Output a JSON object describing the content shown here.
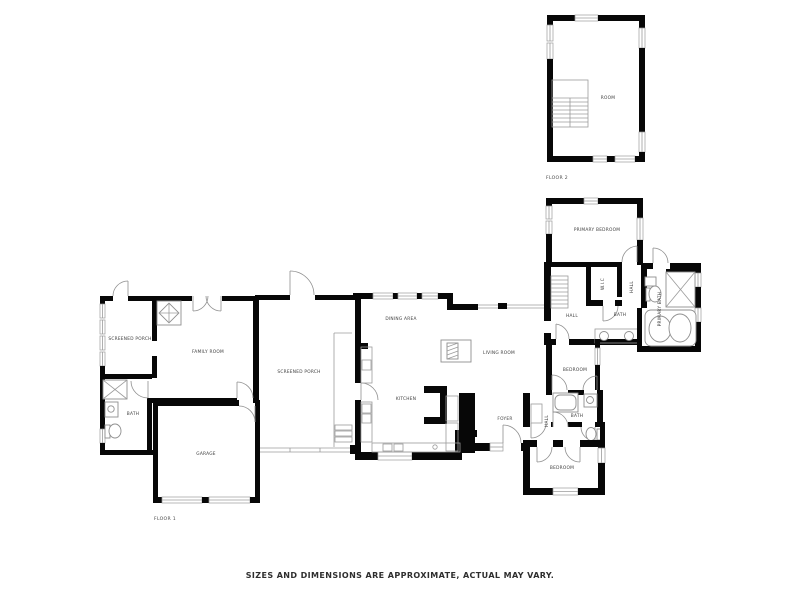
{
  "page": {
    "background": "#ffffff",
    "wall_color": "#070707",
    "line_color": "#9b9b9b",
    "label_color": "#3c3c3c"
  },
  "disclaimer": "SIZES AND DIMENSIONS ARE APPROXIMATE, ACTUAL MAY VARY.",
  "floor_2": {
    "caption": "FLOOR 2",
    "rooms": {
      "room": "ROOM"
    }
  },
  "floor_1": {
    "caption": "FLOOR 1",
    "rooms": {
      "screened_porch_west": "SCREENED PORCH",
      "family_room": "FAMILY ROOM",
      "bath_west": "BATH",
      "garage": "GARAGE",
      "screened_porch_center": "SCREENED PORCH",
      "dining_area": "DINING AREA",
      "kitchen": "KITCHEN",
      "living_room": "LIVING ROOM",
      "foyer": "FOYER",
      "primary_bedroom": "PRIMARY BEDROOM",
      "wic": "W.I.C",
      "hall_closet": "HALL",
      "bath_hall": "BATH",
      "primary_bath": "PRIMARY BATH",
      "hall_stairs": "HALL",
      "bedroom_middle": "BEDROOM",
      "hall_bedrooms": "HALL",
      "bath_bedrooms": "BATH",
      "bedroom_south": "BEDROOM"
    }
  }
}
